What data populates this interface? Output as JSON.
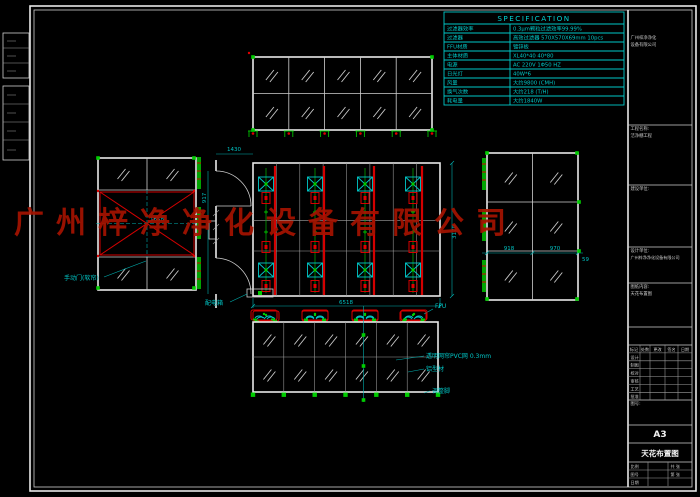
{
  "watermark": "广州梓净净化设备有限公司",
  "colors": {
    "background": "#000000",
    "frame_white": "#e8e8e8",
    "cad_cyan": "#00c8c8",
    "cad_green": "#00cc00",
    "cad_red": "#d40000",
    "watermark_red": "#a51300"
  },
  "spec_table": {
    "title": "SPECIFICATION",
    "rows": [
      {
        "label": "过滤器效率",
        "value": "0.3μm颗粒过滤效率99.99%"
      },
      {
        "label": "过滤器",
        "value": "高效过滤器 570X570X69mm 10pcs"
      },
      {
        "label": "FFU材质",
        "value": "镀锌板"
      },
      {
        "label": "主体材质",
        "value": "XL40*40  40*80"
      },
      {
        "label": "电源",
        "value": "AC 220V 1Φ50 HZ"
      },
      {
        "label": "日光灯",
        "value": "40W*6"
      },
      {
        "label": "风量",
        "value": "大约9800 (CMH)"
      },
      {
        "label": "换气次数",
        "value": "大约218 (T/H)"
      },
      {
        "label": "耗电量",
        "value": "大约1840W"
      }
    ]
  },
  "plan": {
    "dim_bottom": "6518",
    "dim_right": "3170",
    "dim_left": "917",
    "dim_top": "1430",
    "ffu_label": "FFU",
    "power_box": "配电箱"
  },
  "left_elev": {
    "dim_center": "1658",
    "manual_door": "手动门(软帘)"
  },
  "right_elev": {
    "dim1": "918",
    "dim2": "970",
    "dim3": "59"
  },
  "bottom_elev": {
    "ann_pvc": "透明网帘PVC网 0.3mm",
    "ann_alu": "铝型材",
    "ann_foot": "调整脚"
  },
  "title_block": {
    "company1": "广州梓净净化",
    "company2": "设备有限公司",
    "project_label": "工程名称:",
    "project_value": "洁净棚工程",
    "client_label": "建设单位:",
    "design_label": "设计单位:",
    "design_value": "广州梓净净化设备有限公司",
    "content_label": "图纸内容:",
    "content_value": "天花布置图",
    "no_label": "图号:",
    "rev_headers": [
      "标记",
      "处数",
      "更改",
      "签名",
      "日期"
    ],
    "sig_rows": [
      "设计",
      "制图",
      "校对",
      "审核",
      "工艺",
      "批准"
    ],
    "paper_size": "A3",
    "sheet_title": "天花布置图",
    "scale_label": "比例",
    "number_label": "图号",
    "date_label": "日期",
    "sheets_label": "共 张",
    "page_label": "第 张"
  }
}
